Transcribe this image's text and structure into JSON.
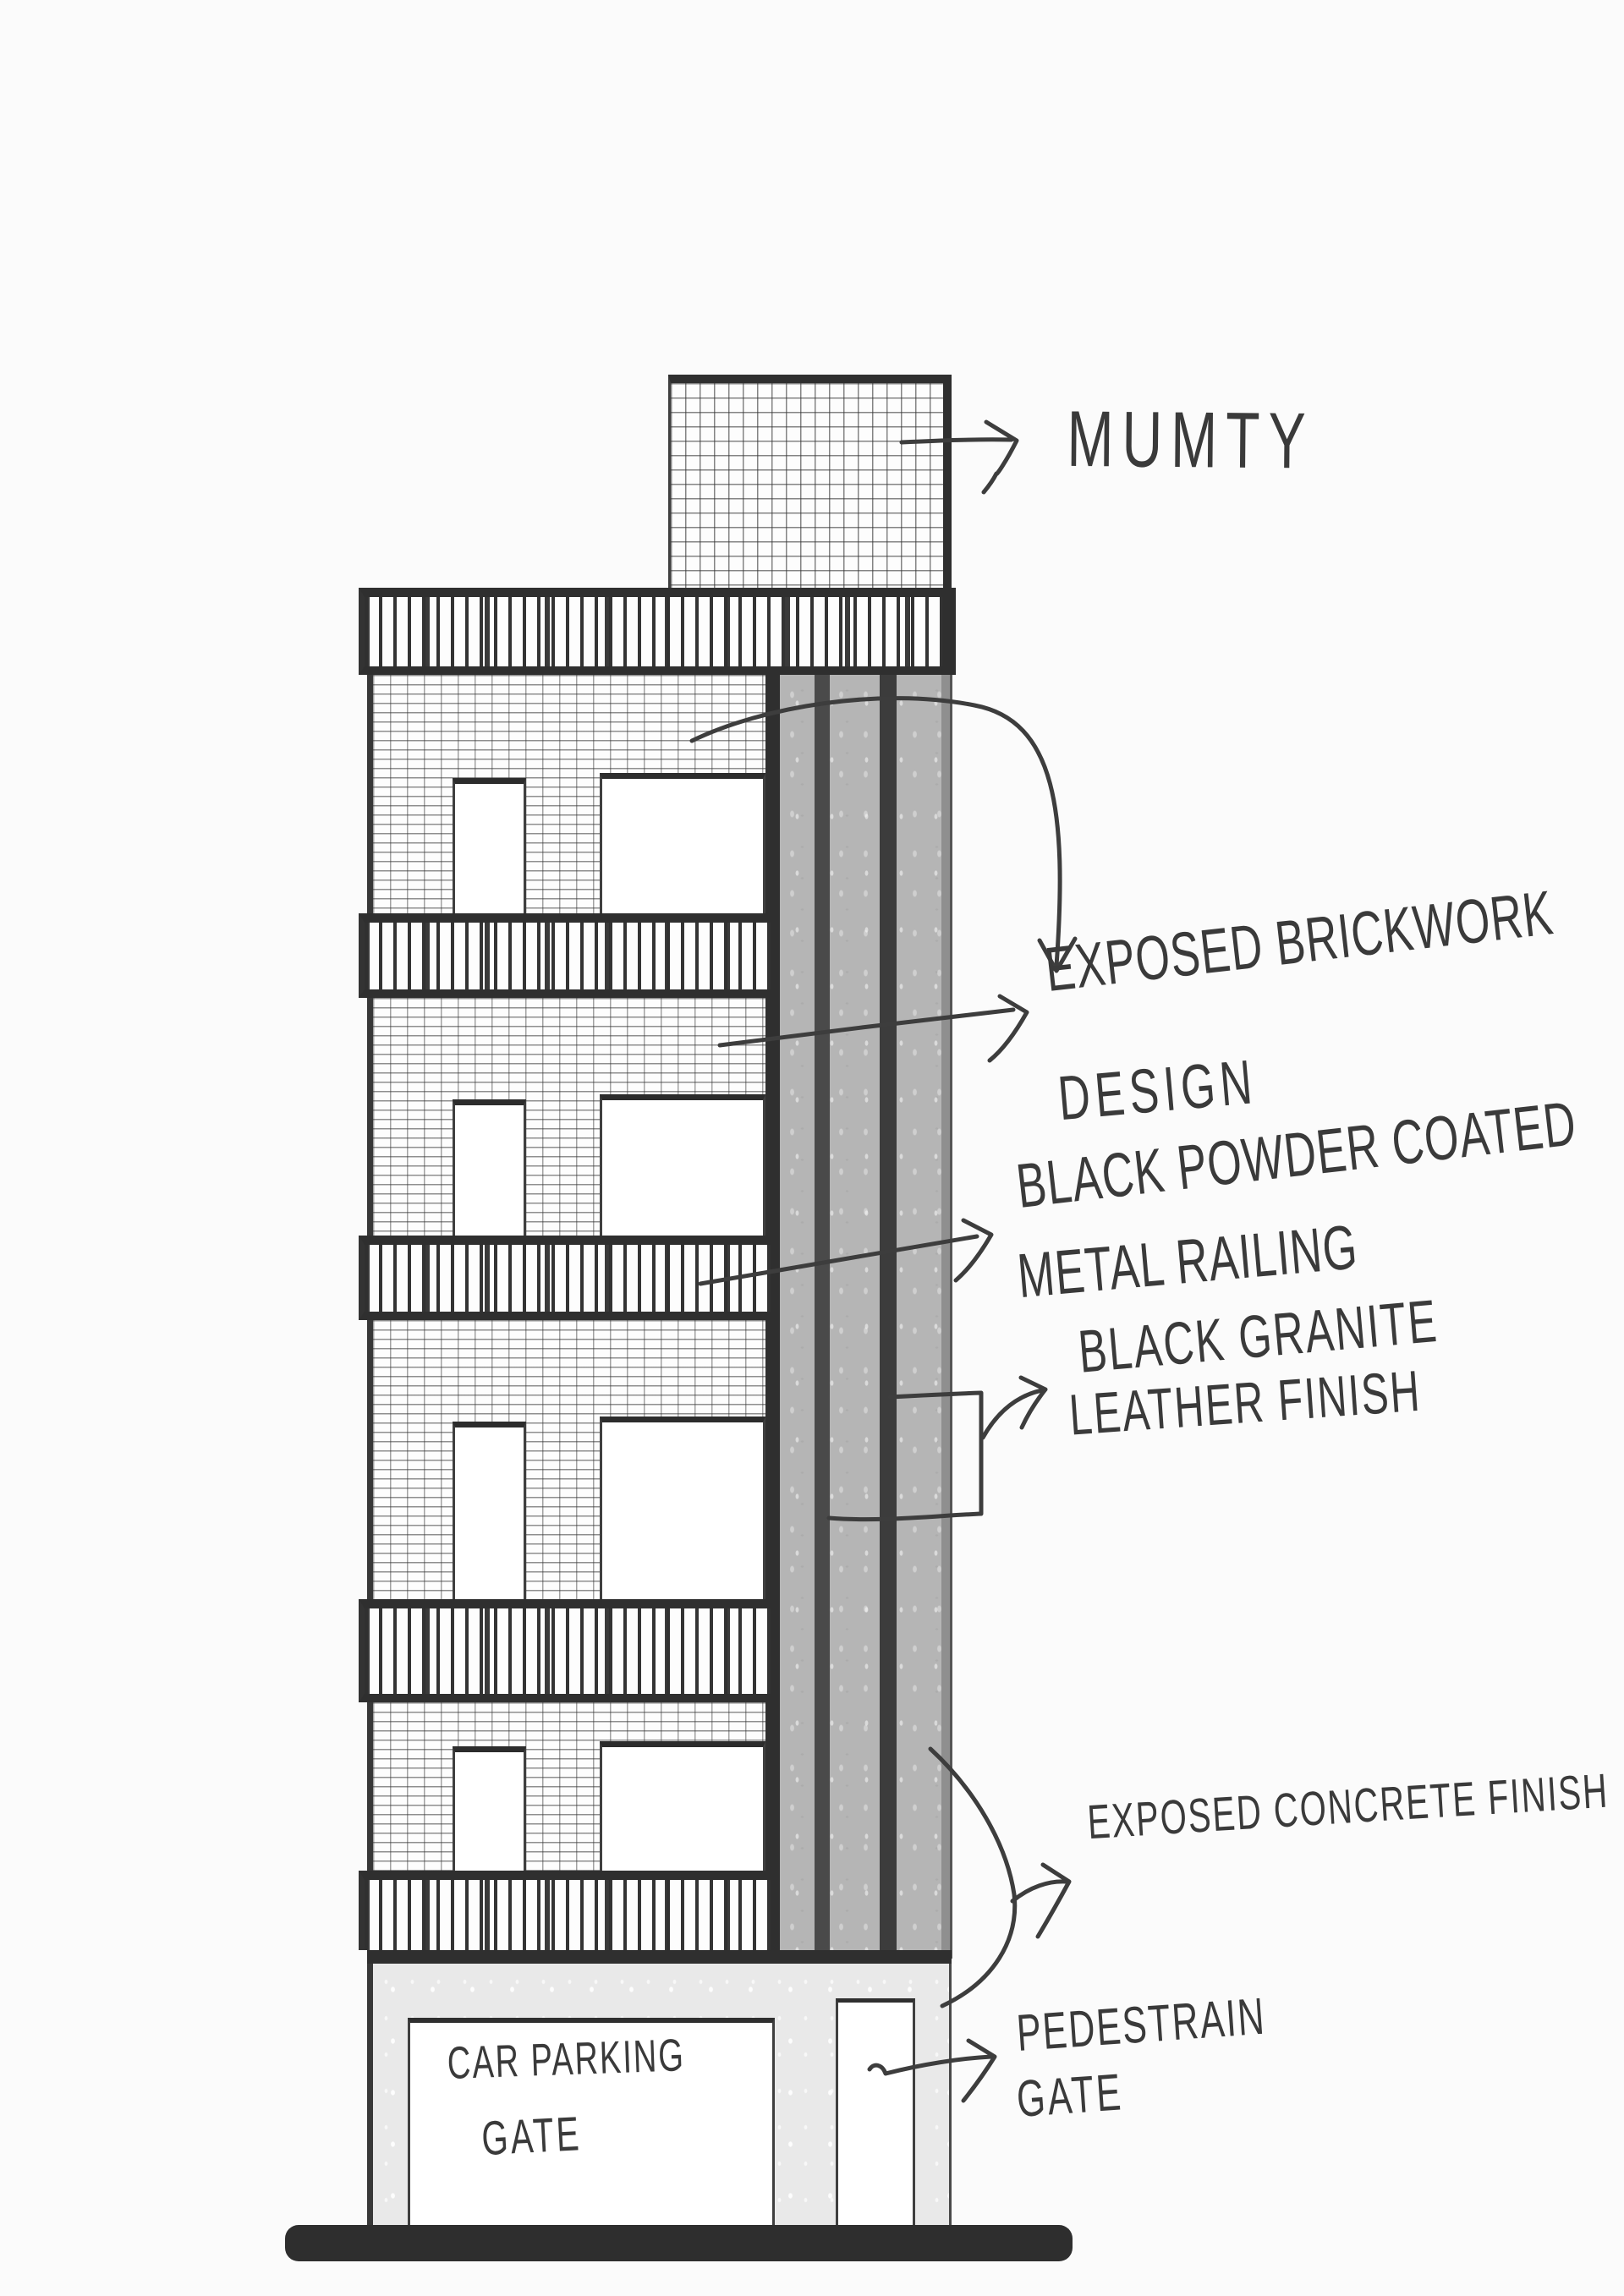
{
  "annotations": {
    "mumty": {
      "text": "MUMTY"
    },
    "brickwork": {
      "line1": "EXPOSED BRICKWORK",
      "line2": "DESIGN"
    },
    "railing": {
      "line1": "BLACK POWDER COATED",
      "line2": "METAL RAILING"
    },
    "granite": {
      "line1": "BLACK GRANITE",
      "line2": "LEATHER FINISH"
    },
    "concrete": {
      "text": "EXPOSED CONCRETE FINISH"
    },
    "pedestrian_gate": {
      "line1": "PEDESTRAIN",
      "line2": "GATE"
    },
    "car_parking_gate": {
      "line1": "CAR PARKING",
      "line2": "GATE"
    }
  },
  "colors": {
    "paper": "#fbfbfb",
    "ink": "#3a3a3a",
    "slab": "#2f2f2f",
    "concrete_column": "#b5b5b5",
    "granite_stripe_left": "#4a4a4a",
    "granite_stripe_right": "#3c3c3c",
    "column_edge_band": "#8f8f8f",
    "ground_wall": "#e9e9e9",
    "street_line": "#2e2e2e"
  }
}
